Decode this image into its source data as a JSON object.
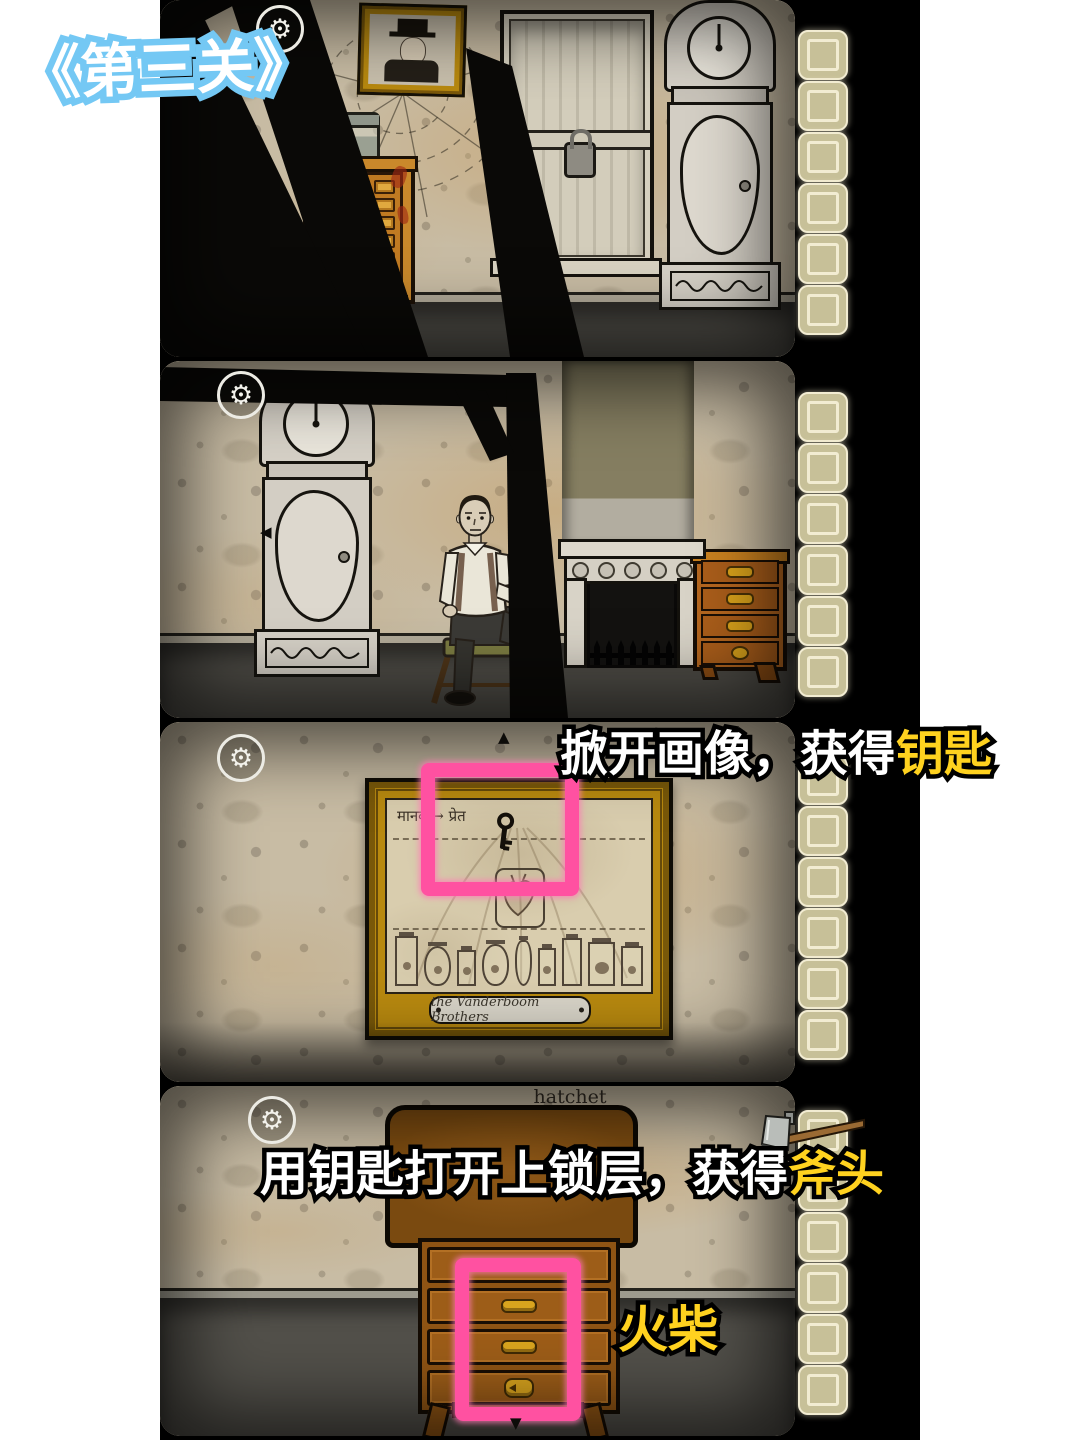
{
  "page": {
    "background": "#ffffff",
    "film_background": "#000000"
  },
  "badge": {
    "label": "《第三关》",
    "text_color": "#ffffff",
    "outline_color": "#74c8f4"
  },
  "hud": {
    "gear_glyph": "⚙",
    "nav_left_glyph": "◀",
    "nav_up_glyph": "▲",
    "nav_down_glyph": "▼"
  },
  "inventory": {
    "slots_per_panel": 6,
    "slot_color": "#c7c098",
    "slot_border_color": "#f2ecd2"
  },
  "annotations": {
    "step1": {
      "white": "掀开画像，获得",
      "yellow": "钥匙"
    },
    "step2": {
      "white": "用钥匙打开上锁层，获得",
      "yellow": "斧头"
    },
    "matches": "火柴",
    "yellow_color": "#ffd21f",
    "highlight_color": "#ff51a1"
  },
  "panel3": {
    "portrait_caption": "मानव → प्रेत",
    "portrait_plaque": "the Vanderboom Brothers"
  },
  "panel4": {
    "item_label": "hatchet"
  }
}
